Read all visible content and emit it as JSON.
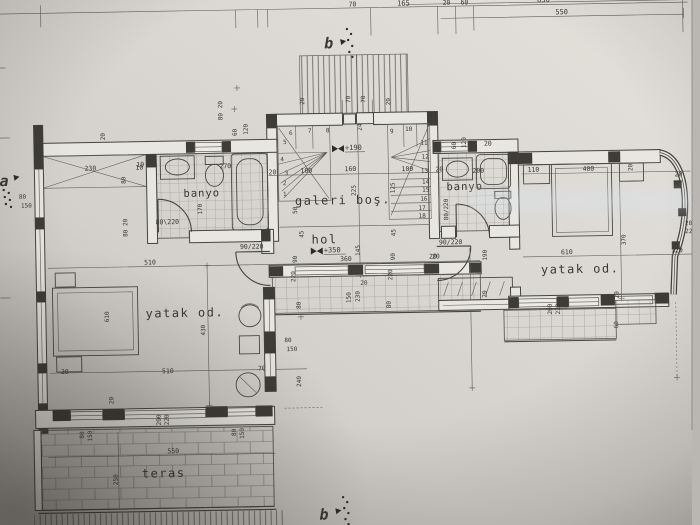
{
  "drawing": {
    "rooms": {
      "banyo_left": "banyo",
      "banyo_right": "banyo",
      "galeri": "galeri boş.",
      "hol": "hol",
      "yatak_left": "yatak od.",
      "yatak_right": "yatak od.",
      "teras": "teras"
    },
    "levels": {
      "galeri": "+190",
      "hol": "+350"
    },
    "markers": {
      "section_b": "b",
      "section_a": "a"
    },
    "doors": {
      "left_banyo": "80\\220",
      "hol": "90/220",
      "right_banyo": "80/220"
    },
    "stair_steps": [
      "1",
      "2",
      "3",
      "4",
      "5",
      "6",
      "7",
      "8",
      "9",
      "10",
      "11",
      "12",
      "13",
      "14",
      "15",
      "16",
      "17",
      "18"
    ],
    "dims": {
      "d10": "10",
      "d20": "20",
      "d24": "24",
      "d45": "45",
      "d50": "50",
      "d60": "60",
      "d70": "70",
      "d80": "80",
      "d90": "90",
      "d100": "100",
      "d110": "110",
      "d120": "120",
      "d125": "125",
      "d145": "145",
      "d150": "150",
      "d160": "160",
      "d165": "165",
      "d170": "170",
      "d190": "190",
      "d200": "200",
      "d220": "220",
      "d225": "225",
      "d230": "230",
      "d240": "240",
      "d250": "250",
      "d270": "270",
      "d360": "360",
      "d370": "370",
      "d400": "400",
      "d430": "430",
      "d510": "510",
      "d550": "550",
      "d610": "610",
      "d630": "630"
    }
  }
}
